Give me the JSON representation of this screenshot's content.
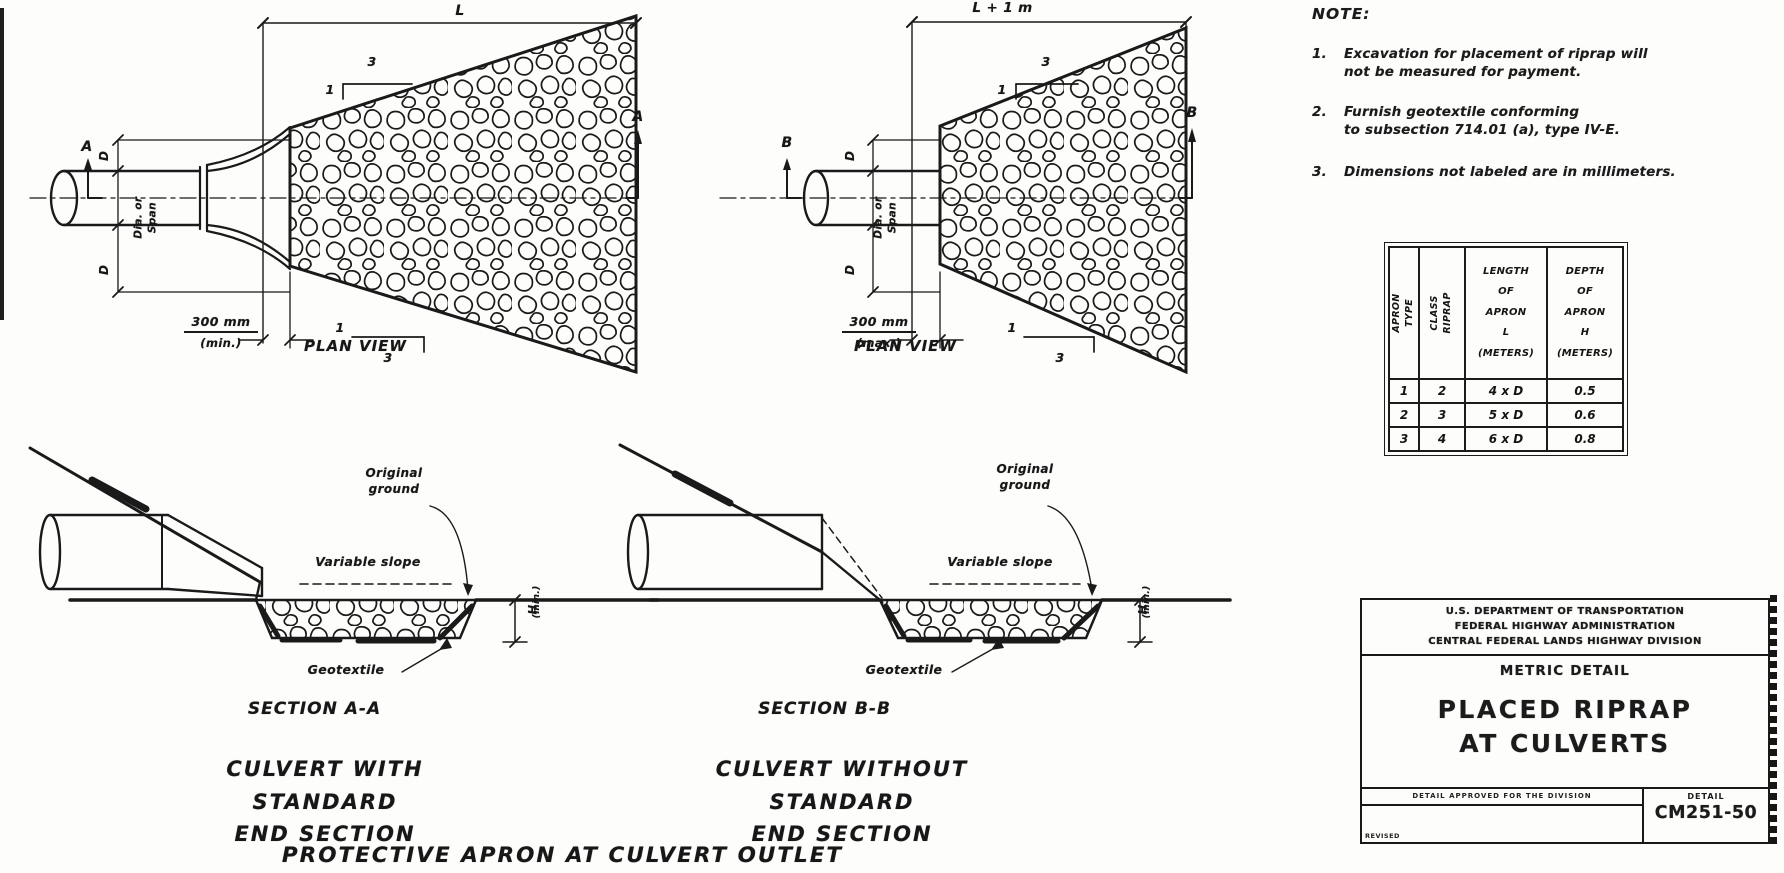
{
  "page": {
    "background": "#fdfdfc",
    "ink": "#1a1a1a"
  },
  "plan_left": {
    "dim_length": "L",
    "slope_rise": "1",
    "slope_run": "3",
    "marker": "A",
    "dim_d": "D",
    "pipe_label": "Dia. or Span",
    "offset_value": "300 mm",
    "offset_qualifier": "(min.)",
    "caption": "PLAN VIEW"
  },
  "plan_right": {
    "dim_length": "L + 1 m",
    "slope_rise": "1",
    "slope_run": "3",
    "marker": "B",
    "dim_d": "D",
    "pipe_label": "Dia. or Span",
    "offset_value": "300 mm",
    "offset_qualifier": "(max.)",
    "caption": "PLAN VIEW"
  },
  "sections": {
    "a": {
      "caption": "SECTION A-A",
      "subcaption": "CULVERT WITH STANDARD\nEND SECTION"
    },
    "b": {
      "caption": "SECTION B-B",
      "subcaption": "CULVERT WITHOUT STANDARD\nEND SECTION"
    },
    "labels": {
      "original_ground": "Original\nground",
      "variable_slope": "Variable slope",
      "geotextile": "Geotextile",
      "depth": "H",
      "depth_qualifier": "(min.)"
    }
  },
  "footer": {
    "caption": "PROTECTIVE APRON AT CULVERT OUTLET"
  },
  "notes": {
    "heading": "NOTE:",
    "n1": {
      "num": "1.",
      "l1": "Excavation for placement of riprap will",
      "l2": "not be measured for payment."
    },
    "n2": {
      "num": "2.",
      "l1": "Furnish geotextile conforming",
      "l2": "to subsection 714.01 (a), type IV-E."
    },
    "n3": {
      "num": "3.",
      "l1": "Dimensions not labeled are in millimeters."
    }
  },
  "riprap_table": {
    "header_apron": "APRON\nTYPE",
    "header_class": "CLASS\nRIPRAP",
    "header_length": "LENGTH\nOF\nAPRON\nL\n(METERS)",
    "header_depth": "DEPTH\nOF\nAPRON\nH\n(METERS)",
    "rows": [
      [
        "1",
        "2",
        "4 x D",
        "0.5"
      ],
      [
        "2",
        "3",
        "5 x D",
        "0.6"
      ],
      [
        "3",
        "4",
        "6 x D",
        "0.8"
      ]
    ]
  },
  "title_block": {
    "agency_line1": "U.S. DEPARTMENT OF TRANSPORTATION",
    "agency_line2": "FEDERAL HIGHWAY ADMINISTRATION",
    "agency_line3": "CENTRAL FEDERAL LANDS HIGHWAY DIVISION",
    "subtitle": "METRIC DETAIL",
    "title": "PLACED RIPRAP\nAT CULVERTS",
    "approval_text": "DETAIL APPROVED FOR THE DIVISION",
    "revised_label": "REVISED",
    "detail_label": "DETAIL",
    "detail_number": "CM251-50"
  }
}
